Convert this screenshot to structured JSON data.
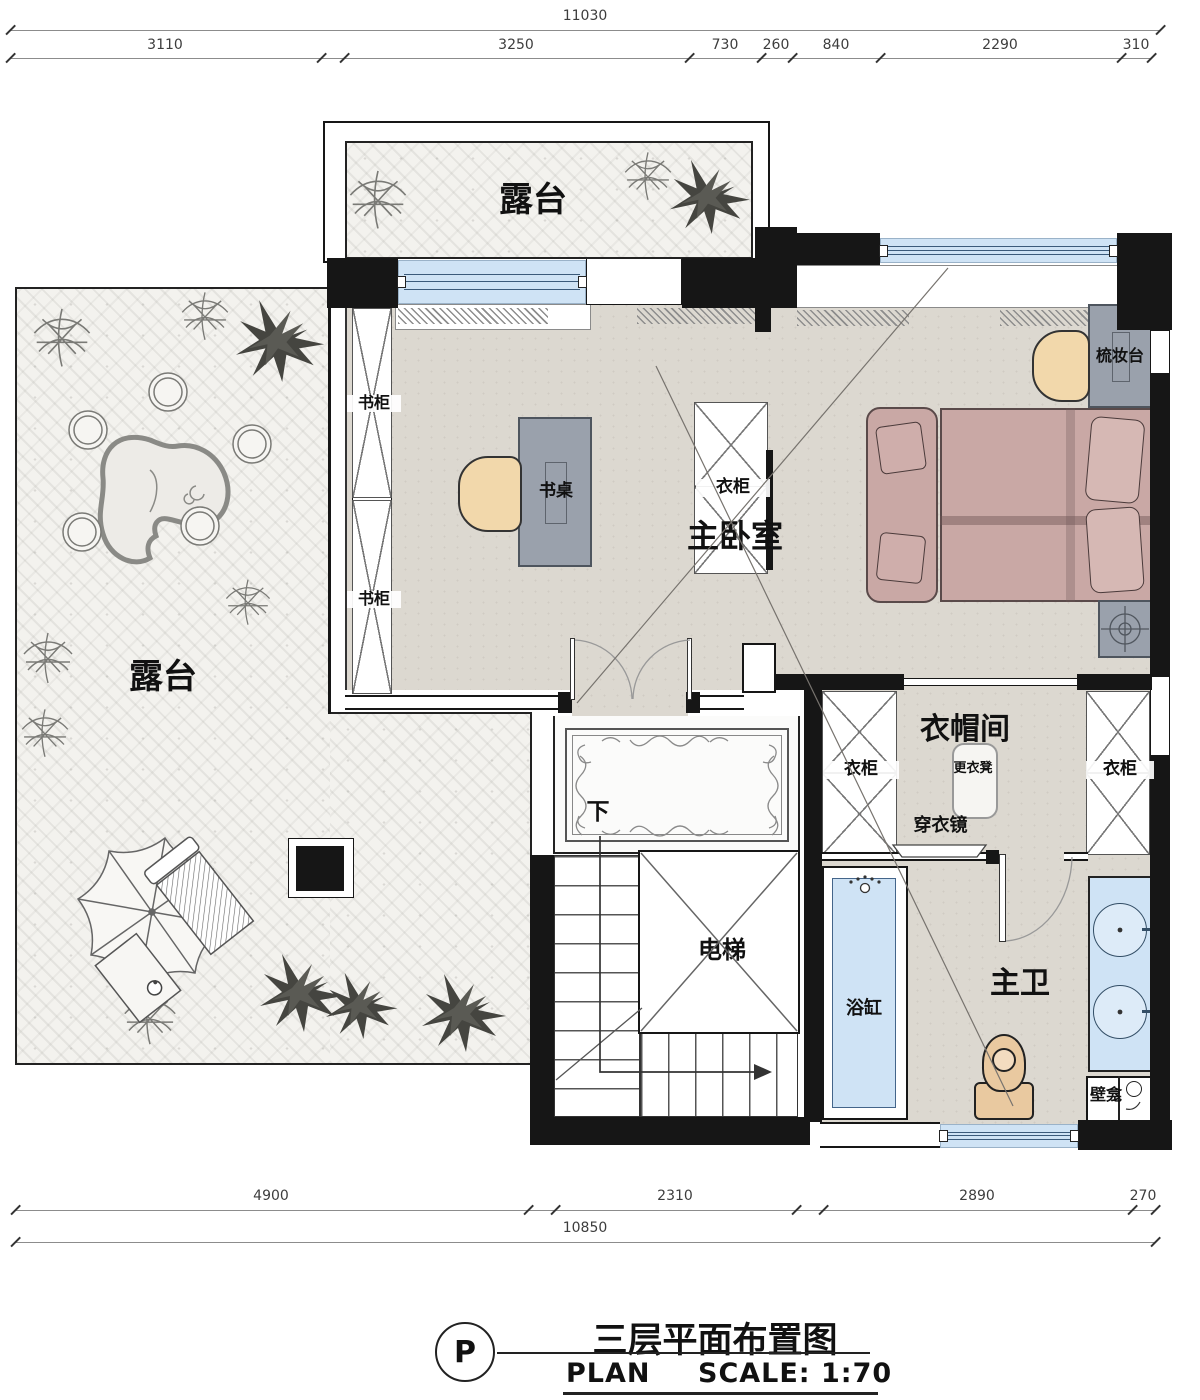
{
  "dims": {
    "top": {
      "total": "11030",
      "segs": [
        "3110",
        "3250",
        "730",
        "260",
        "840",
        "2290",
        "310"
      ]
    },
    "bottom": {
      "total": "10850",
      "segs": [
        "4900",
        "2310",
        "2890",
        "270"
      ]
    }
  },
  "labels": {
    "terrace_top": "露台",
    "terrace_left": "露台",
    "master_bedroom": "主卧室",
    "cloakroom": "衣帽间",
    "master_bath": "主卫",
    "elevator": "电梯",
    "bookcase_a": "书柜",
    "bookcase_b": "书柜",
    "desk": "书桌",
    "wardrobe_free": "衣柜",
    "wardrobe_left": "衣柜",
    "wardrobe_right": "衣柜",
    "dresser": "梳妆台",
    "stool": "更衣凳",
    "mirror": "穿衣镜",
    "bathtub": "浴缸",
    "niche": "壁龛",
    "down": "下"
  },
  "title": {
    "marker": "P",
    "cn": "三层平面布置图",
    "en_plan": "PLAN",
    "en_scale": "SCALE: 1:70"
  },
  "colors": {
    "wall": "#161616",
    "floor": "#dcd8d0",
    "terrace": "#f3f2ee",
    "window_blue": "#cfe3f5",
    "bed_pink": "#c9a8a5",
    "wood_tan": "#f2d8ab",
    "cabinet_gray": "#9aa1ac"
  }
}
